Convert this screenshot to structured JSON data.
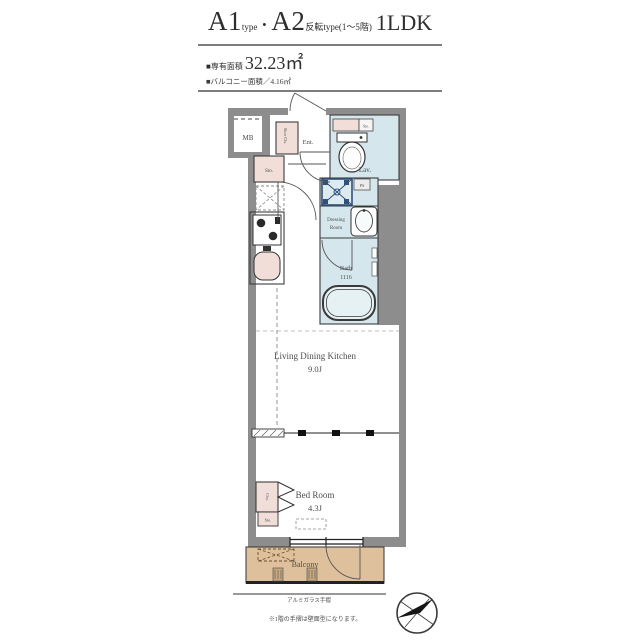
{
  "header": {
    "a1": "A1",
    "a1_sub": "type",
    "separator": "・",
    "a2": "A2",
    "a2_sub": "反転type",
    "a2_floors": "(1〜5階)",
    "plan_type": "1LDK",
    "area_label": "■専有面積",
    "area_value": "32.23㎡",
    "balcony_area_label": "■バルコニー面積／4.16㎡"
  },
  "plan": {
    "mb": "MB",
    "entrance": "Ent.",
    "shoe_closet": "Shoe Cls.",
    "lavatory": "Lav.",
    "storage_hall": "Sto.",
    "storage_lavatory": "Sto.",
    "pipe_space": "PS",
    "dressing_room_line1": "Dressing",
    "dressing_room_line2": "Room",
    "bath_label": "Bath",
    "bath_size": "1116",
    "ldk_label": "Living Dining Kitchen",
    "ldk_size": "9.0J",
    "bedroom_label": "Bed Room",
    "bedroom_size": "4.3J",
    "closet": "Clo.",
    "storage_bedroom": "Sto.",
    "balcony": "Balcony"
  },
  "annotations": {
    "handrail": "アルミガラス手摺",
    "first_floor_note": "※1階の手摺は壁面型になります。"
  },
  "colors": {
    "wall": "#8d8d8d",
    "wet": "#d5e6ec",
    "wet_light": "#e7f1f4",
    "pink": "#f1ded8",
    "tan": "#dec19c",
    "navy": "#31507a",
    "line": "#3c3c3c",
    "label": "#4d4d4d"
  }
}
